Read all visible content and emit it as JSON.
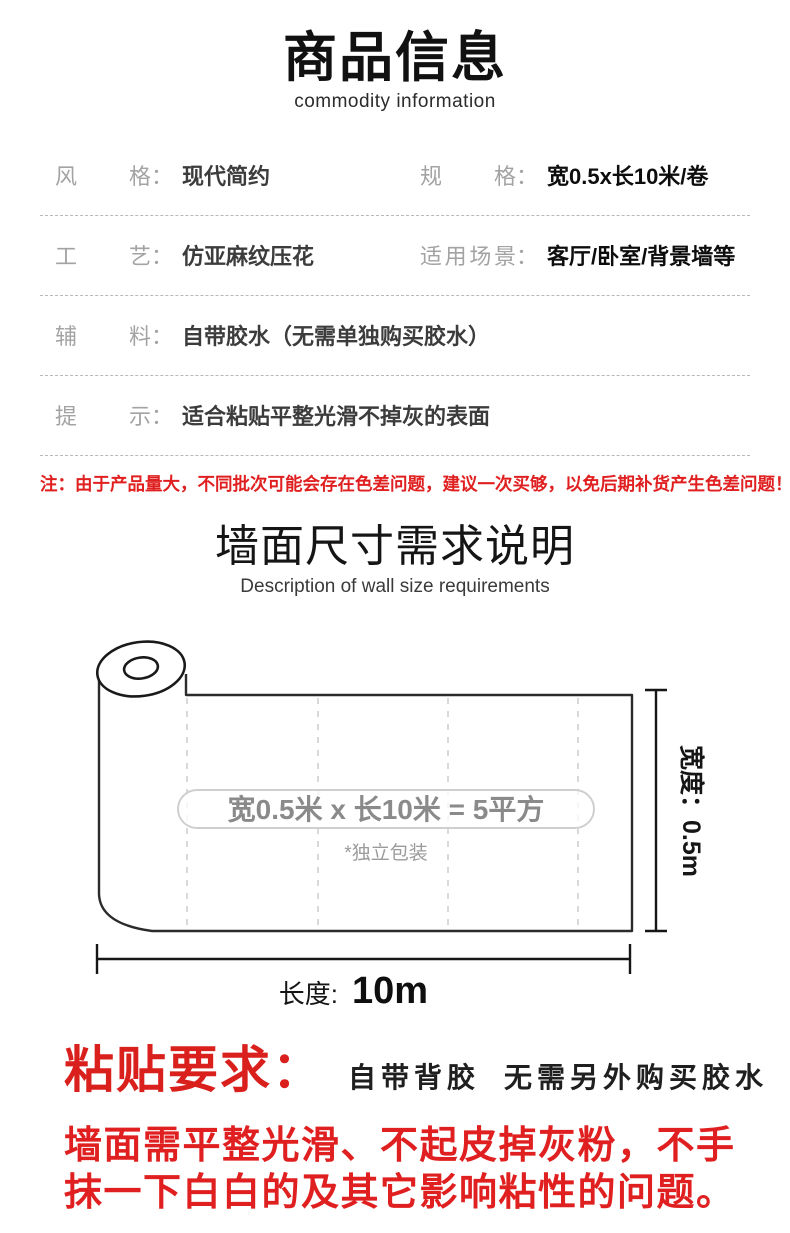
{
  "header": {
    "title": "商品信息",
    "subtitle": "commodity information"
  },
  "specs": {
    "colon": "：",
    "rows": [
      {
        "left": {
          "label": "风格",
          "value": "现代简约"
        },
        "right": {
          "label": "规格",
          "value": "宽0.5x长10米/卷"
        }
      },
      {
        "left": {
          "label": "工艺",
          "value": "仿亚麻纹压花"
        },
        "right": {
          "label": "适用场景",
          "value": "客厅/卧室/背景墙等"
        }
      },
      {
        "left": {
          "label": "辅料",
          "value": "自带胶水（无需单独购买胶水）"
        }
      },
      {
        "left": {
          "label": "提示",
          "value": "适合粘贴平整光滑不掉灰的表面"
        }
      }
    ]
  },
  "notice": "注：由于产品量大，不同批次可能会存在色差问题，建议一次买够，以免后期补货产生色差问题！",
  "size_section": {
    "title": "墙面尺寸需求说明",
    "subtitle": "Description of wall size requirements",
    "diagram": {
      "roll_label": "宽0.5米 x 长10米 = 5平方",
      "packaging_note": "*独立包装",
      "width_label": "宽度：0.5m",
      "length_label": "长度:",
      "length_value": "10m"
    }
  },
  "requirements": {
    "heading": "粘贴要求：",
    "subheading": "自带背胶  无需另外购买胶水",
    "body_lines": [
      "墙面需平整光滑、不起皮掉灰粉，不手",
      "抹一下白白的及其它影响粘性的问题。"
    ]
  },
  "colors": {
    "notice_red": "#e02020",
    "heading_red": "#d9201d",
    "body_red": "#e02020",
    "label_gray": "#a3a3a3",
    "pill_text_gray": "#8a8a8a",
    "outline_dark": "#1a1a1a"
  }
}
